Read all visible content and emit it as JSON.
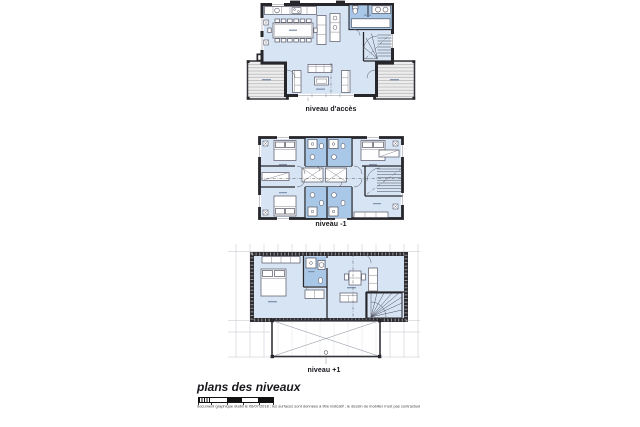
{
  "document_type": "architectural floor plans",
  "plans": [
    {
      "id": "acces",
      "label": "niveau d'accès"
    },
    {
      "id": "minus1",
      "label": "niveau -1"
    },
    {
      "id": "plus1",
      "label": "niveau +1"
    }
  ],
  "footer": {
    "title": "plans des niveaux",
    "disclaimer": "document graphique établi le 06/07/2018 ; les surfaces sont données à titre indicatif ; le dessin du mobilier n'est pas contractuel"
  },
  "colors": {
    "interior": "#d6e4f4",
    "wet_room": "#a9c7e7",
    "wall_ink": "#26262b",
    "terrace": "#ededed",
    "grid": "#c3c3cb",
    "background": "#ffffff"
  }
}
